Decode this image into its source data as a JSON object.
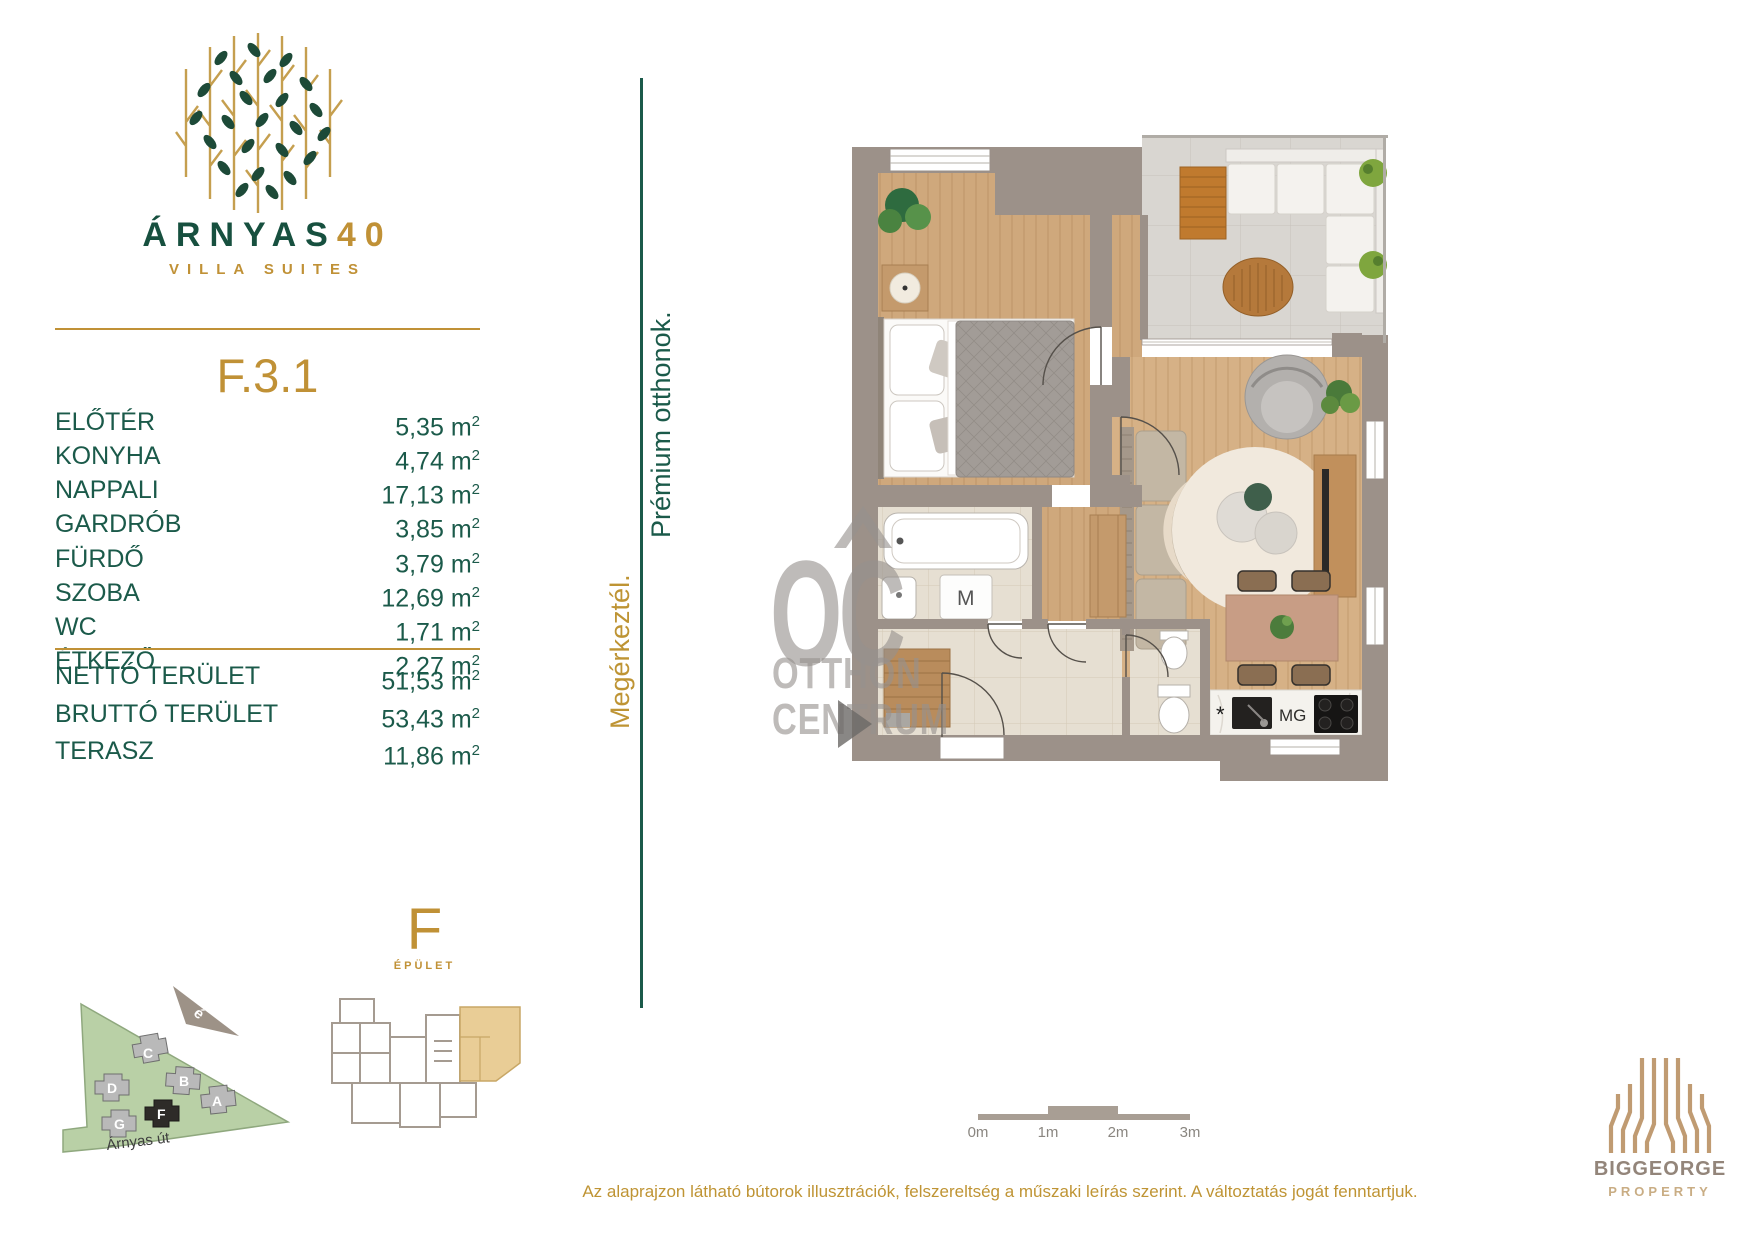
{
  "brand": {
    "main": "ÁRNYAS",
    "number": "40",
    "subtitle": "VILLA SUITES"
  },
  "unit_id": "F.3.1",
  "unit": {
    "base": "m",
    "exp": "2"
  },
  "rooms": [
    {
      "label": "ELŐTÉR",
      "area": "5,35"
    },
    {
      "label": "KONYHA",
      "area": "4,74"
    },
    {
      "label": "NAPPALI",
      "area": "17,13"
    },
    {
      "label": "GARDRÓB",
      "area": "3,85"
    },
    {
      "label": "FÜRDŐ",
      "area": "3,79"
    },
    {
      "label": "SZOBA",
      "area": "12,69"
    },
    {
      "label": "WC",
      "area": "1,71"
    },
    {
      "label": "ÉTKEZŐ",
      "area": "2,27"
    }
  ],
  "totals": [
    {
      "label": "NETTÓ TERÜLET",
      "area": "51,53"
    },
    {
      "label": "BRUTTÓ TERÜLET",
      "area": "53,43"
    },
    {
      "label": "TERASZ",
      "area": "11,86"
    }
  ],
  "banner": {
    "green": "Prémium otthonok.",
    "gold": "Megérkeztél."
  },
  "plan": {
    "washer": "M",
    "oven": "MG",
    "star": "*"
  },
  "watermark": {
    "abbr": "OC",
    "top": "OTTHON",
    "bottom": "CENTRUM"
  },
  "scale": {
    "labels": [
      "0m",
      "1m",
      "2m",
      "3m"
    ]
  },
  "site": {
    "compass": "é",
    "street": "Árnyas út",
    "buildings": [
      "C",
      "D",
      "B",
      "A",
      "G",
      "F"
    ],
    "highlighted": "F"
  },
  "key_plan": {
    "letter": "F",
    "caption": "ÉPÜLET"
  },
  "publisher": {
    "name": "BIGGEORGE",
    "division": "PROPERTY"
  },
  "footer": {
    "disclaimer": "Az alaprajzon látható bútorok illusztrációk, felszereltség a műszaki leírás szerint. A változtatás jogát fenntartjuk."
  },
  "colors": {
    "green": "#1B5A4A",
    "gold": "#C09136",
    "wall": "#9C9189",
    "wood": "#CFA87C",
    "tile": "#E6DFD2",
    "terrace": "#D9D6D1",
    "site_green": "#B9D0A6",
    "watermark_gray": "#969290",
    "bronze": "#C09B72",
    "leaf_green": "#1D4A38"
  }
}
